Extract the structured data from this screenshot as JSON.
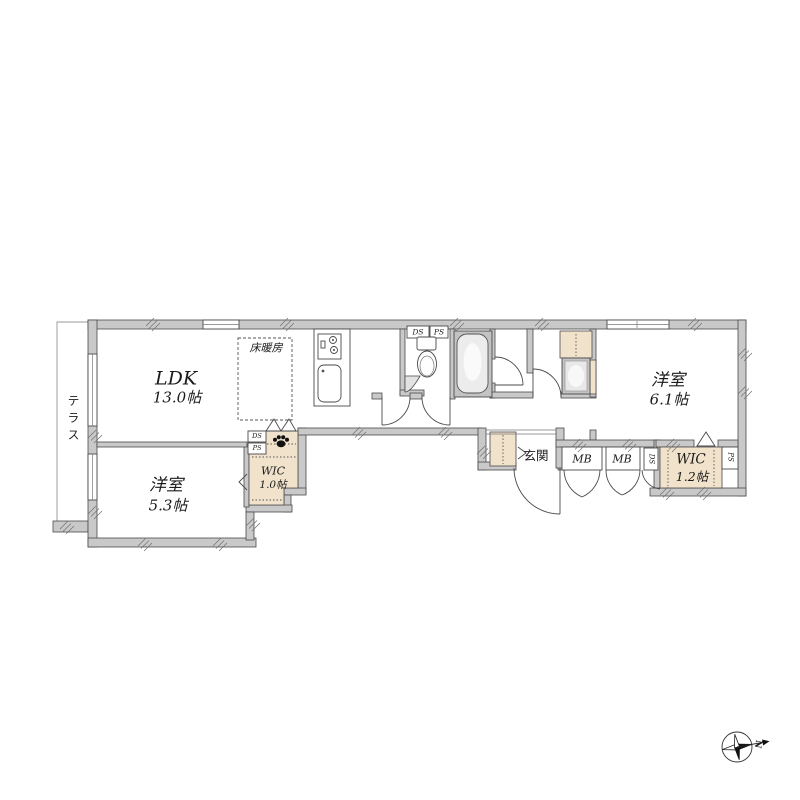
{
  "colors": {
    "wall_fill": "#c9c9c9",
    "wall_line": "#4a4a4a",
    "closet_fill": "#f0e2cb",
    "bath_floor": "#c3c3c3",
    "text": "#1a1a1a"
  },
  "plan": {
    "terrace": {
      "label": "テラス"
    },
    "ldk": {
      "label": "LDK",
      "area": "13.0帖"
    },
    "floor_heating": {
      "label": "床暖房"
    },
    "bedroom_53": {
      "label": "洋室",
      "area": "5.3帖"
    },
    "wic_10": {
      "label": "WIC",
      "area": "1.0帖"
    },
    "bedroom_61": {
      "label": "洋室",
      "area": "6.1帖"
    },
    "wic_12": {
      "label": "WIC",
      "area": "1.2帖"
    },
    "entrance": {
      "label": "玄関"
    },
    "meter_boxes": {
      "mb1": "MB",
      "mb2": "MB"
    },
    "shafts": {
      "ds_toilet": "DS",
      "ps_toilet": "PS",
      "ds_wic10": "DS",
      "ps_wic10": "PS",
      "ds_mb": "DS",
      "ps_wic12": "PS"
    },
    "compass": {
      "north": "N"
    }
  }
}
